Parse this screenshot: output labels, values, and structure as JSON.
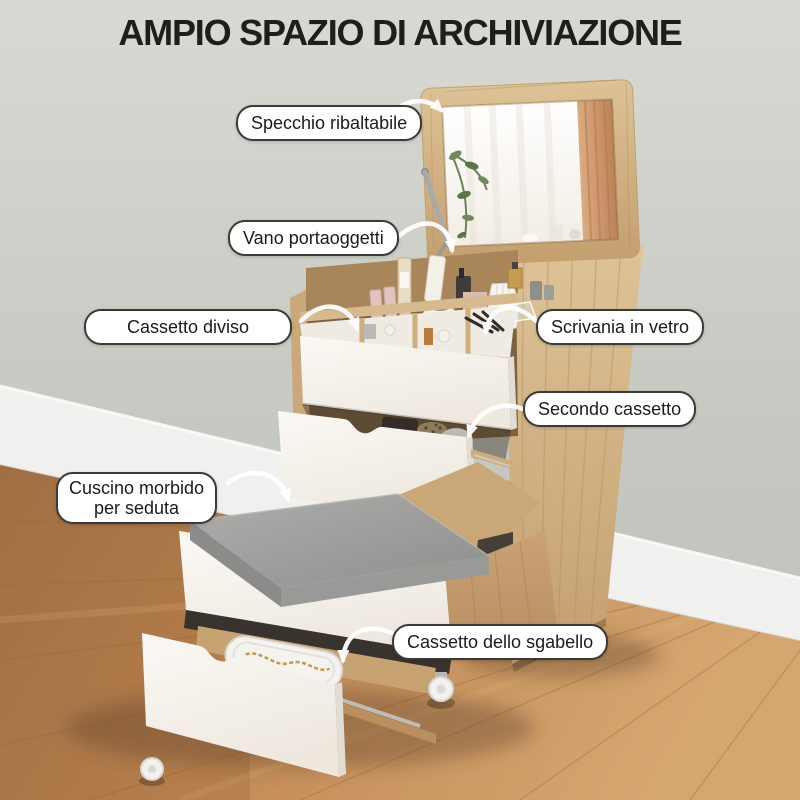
{
  "title": "AMPIO SPAZIO DI ARCHIVIAZIONE",
  "callouts": {
    "specchio": {
      "text": "Specchio ribaltabile"
    },
    "vano": {
      "text": "Vano portaoggetti"
    },
    "cassetto_diviso": {
      "text": "Cassetto diviso"
    },
    "scrivania": {
      "text": "Scrivania in vetro"
    },
    "secondo_cassetto": {
      "text": "Secondo cassetto"
    },
    "cuscino": {
      "line1": "Cuscino morbido",
      "line2": "per seduta"
    },
    "cassetto_sgabello": {
      "text": "Cassetto dello sgabello"
    }
  },
  "colors": {
    "title_color": "#1e1e1e",
    "label_bg": "#ffffff",
    "label_border": "#3a3a3a",
    "arrow": "#ffffff",
    "wall": "#c9cbc5",
    "baseboard": "#f0f1ef",
    "floor_wood": "#c28a57",
    "furniture_oak": "#d2b285",
    "drawer_white": "#f6f3ee",
    "cushion_gray": "#9d9d9b",
    "mirror_curtain_reflection": "#d3a078"
  }
}
